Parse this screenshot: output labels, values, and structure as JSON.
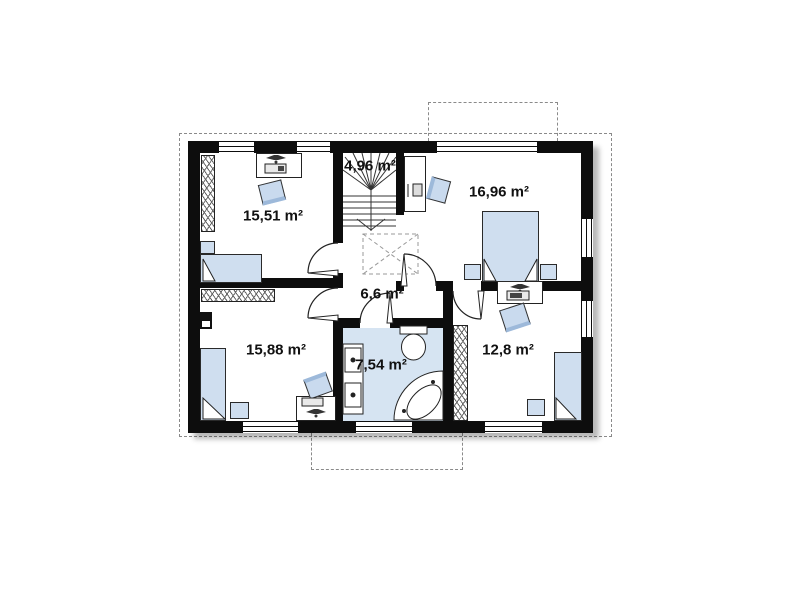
{
  "plan": {
    "type": "floor-plan",
    "rooms": [
      {
        "name": "bedroom-top-left",
        "area_label": "15,51 m²",
        "furniture": [
          "wardrobe",
          "desk",
          "desk-lamp",
          "chair",
          "nightstand",
          "single-bed"
        ]
      },
      {
        "name": "staircase",
        "area_label": "4,96 m²",
        "furniture": [
          "winder-stairs",
          "direction-arrow"
        ]
      },
      {
        "name": "bedroom-top-right",
        "area_label": "16,96 m²",
        "furniture": [
          "desk",
          "chair",
          "double-bed",
          "nightstand",
          "nightstand"
        ]
      },
      {
        "name": "hall",
        "area_label": "6,6 m²",
        "furniture": [
          "ceiling-opening-x"
        ]
      },
      {
        "name": "bedroom-bottom-left",
        "area_label": "15,88 m²",
        "furniture": [
          "wardrobe",
          "tv",
          "single-bed",
          "nightstand",
          "desk",
          "desk-lamp",
          "chair"
        ]
      },
      {
        "name": "bathroom",
        "area_label": "7,54 m²",
        "furniture": [
          "double-washbasin",
          "toilet",
          "corner-bathtub"
        ]
      },
      {
        "name": "bedroom-bottom-right",
        "area_label": "12,8 m²",
        "furniture": [
          "desk",
          "desk-lamp",
          "chair",
          "wardrobe",
          "single-bed",
          "nightstand"
        ]
      }
    ],
    "colors": {
      "wall": "#0d0d0d",
      "furniture_fill": "#cfdeef",
      "furniture_stroke": "#2a2a2a",
      "bathroom_floor": "#d6e4f2",
      "dashed_line": "#8a8a8a",
      "label_text": "#111111"
    },
    "icons": [
      "window",
      "door-arc",
      "wardrobe-hatch",
      "desk-lamp-icon",
      "stairs-icon",
      "toilet-icon",
      "washbasin-icon",
      "bathtub-icon",
      "ceiling-opening-x"
    ]
  }
}
